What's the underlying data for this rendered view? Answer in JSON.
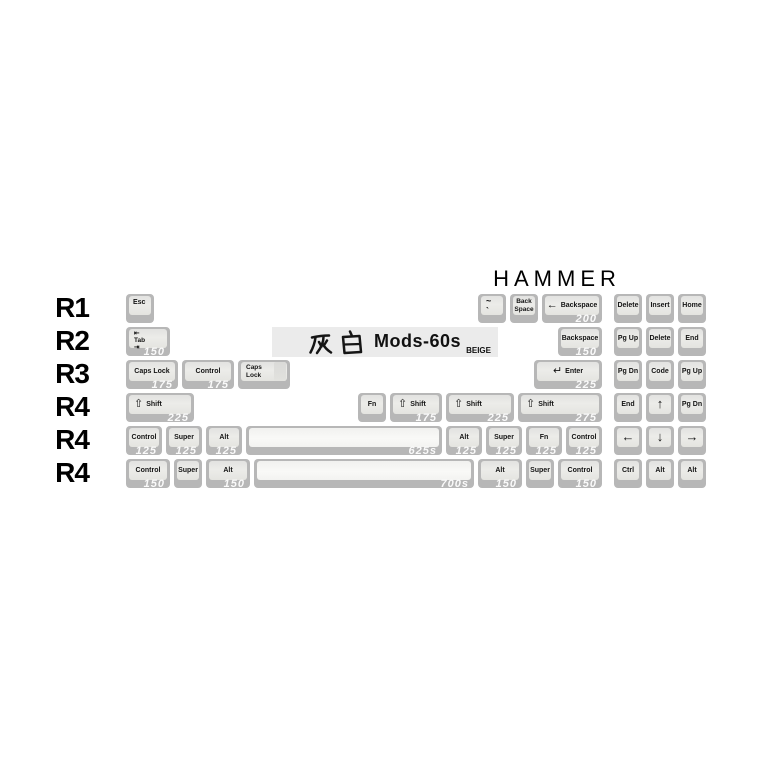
{
  "title": "HAMMER",
  "banner": {
    "cjk": "灰白",
    "series": "Mods-60s",
    "colorway": "BEIGE"
  },
  "colors": {
    "page_bg": "#ffffff",
    "key_base": "#b7b7b7",
    "keycap_top": "#e9e9e7",
    "spacebar_top": "#f6f6f4",
    "legend": "#141414",
    "size_label": "#fafafa",
    "banner_bg": "#ebebeb",
    "title_text": "#000000"
  },
  "rows": [
    {
      "label": "R1",
      "keys": [
        {
          "legend": "Esc",
          "u": 0,
          "w": 1,
          "style": "tl"
        },
        {
          "lines": [
            "~",
            "`"
          ],
          "u": 11,
          "w": 1,
          "name": "tilde",
          "style": "tl2"
        },
        {
          "lines": [
            "Back",
            "Space"
          ],
          "u": 12,
          "w": 1,
          "name": "back-space",
          "style": "two"
        },
        {
          "legend": "Backspace",
          "icon": "←",
          "u": 13,
          "w": 2,
          "size": "200",
          "style": "iconrowc"
        },
        {
          "legend": "Delete",
          "u": 15.25,
          "w": 1
        },
        {
          "legend": "Insert",
          "u": 16.25,
          "w": 1
        },
        {
          "legend": "Home",
          "u": 17.25,
          "w": 1
        }
      ]
    },
    {
      "label": "R2",
      "keys": [
        {
          "lines": [
            "⇤",
            "Tab",
            "⇥"
          ],
          "u": 0,
          "w": 1.5,
          "name": "tab",
          "style": "tabkey",
          "size": "150"
        },
        {
          "legend": "Backspace",
          "u": 13.5,
          "w": 1.5,
          "size": "150"
        },
        {
          "legend": "Pg Up",
          "u": 15.25,
          "w": 1
        },
        {
          "legend": "Delete",
          "u": 16.25,
          "w": 1
        },
        {
          "legend": "End",
          "u": 17.25,
          "w": 1
        }
      ]
    },
    {
      "label": "R3",
      "keys": [
        {
          "legend": "Caps Lock",
          "u": 0,
          "w": 1.75,
          "size": "175"
        },
        {
          "legend": "Control",
          "u": 1.75,
          "w": 1.75,
          "size": "175"
        },
        {
          "lines": [
            "Caps",
            "Lock"
          ],
          "u": 3.5,
          "w": 1.75,
          "name": "caps-lock-stepped",
          "style": "twol",
          "stepped": true
        },
        {
          "legend": "Enter",
          "icon": "↵",
          "u": 12.75,
          "w": 2.25,
          "size": "225",
          "style": "iconrowc"
        },
        {
          "legend": "Pg Dn",
          "u": 15.25,
          "w": 1
        },
        {
          "legend": "Code",
          "u": 16.25,
          "w": 1
        },
        {
          "legend": "Pg Up",
          "u": 17.25,
          "w": 1
        }
      ]
    },
    {
      "label": "R4",
      "keys": [
        {
          "legend": "Shift",
          "icon": "⇧",
          "u": 0,
          "w": 2.25,
          "size": "225",
          "style": "iconrow"
        },
        {
          "legend": "Fn",
          "u": 7.25,
          "w": 1
        },
        {
          "legend": "Shift",
          "icon": "⇧",
          "u": 8.25,
          "w": 1.75,
          "size": "175",
          "style": "iconrow"
        },
        {
          "legend": "Shift",
          "icon": "⇧",
          "u": 10,
          "w": 2.25,
          "size": "225",
          "style": "iconrow"
        },
        {
          "legend": "Shift",
          "icon": "⇧",
          "u": 12.25,
          "w": 2.75,
          "size": "275",
          "style": "iconrow"
        },
        {
          "legend": "End",
          "u": 15.25,
          "w": 1
        },
        {
          "legend": "↑",
          "u": 16.25,
          "w": 1,
          "big": true,
          "name": "up-arrow"
        },
        {
          "legend": "Pg Dn",
          "u": 17.25,
          "w": 1
        }
      ]
    },
    {
      "label": "R4",
      "keys": [
        {
          "legend": "Control",
          "u": 0,
          "w": 1.25,
          "size": "125"
        },
        {
          "legend": "Super",
          "u": 1.25,
          "w": 1.25,
          "size": "125"
        },
        {
          "legend": "Alt",
          "u": 2.5,
          "w": 1.25,
          "size": "125"
        },
        {
          "legend": "",
          "u": 3.75,
          "w": 6.25,
          "size": "625s",
          "space": true,
          "name": "spacebar-625"
        },
        {
          "legend": "Alt",
          "u": 10,
          "w": 1.25,
          "size": "125"
        },
        {
          "legend": "Super",
          "u": 11.25,
          "w": 1.25,
          "size": "125"
        },
        {
          "legend": "Fn",
          "u": 12.5,
          "w": 1.25,
          "size": "125"
        },
        {
          "legend": "Control",
          "u": 13.75,
          "w": 1.25,
          "size": "125"
        },
        {
          "legend": "←",
          "u": 15.25,
          "w": 1,
          "big": true,
          "name": "left-arrow"
        },
        {
          "legend": "↓",
          "u": 16.25,
          "w": 1,
          "big": true,
          "name": "down-arrow"
        },
        {
          "legend": "→",
          "u": 17.25,
          "w": 1,
          "big": true,
          "name": "right-arrow"
        }
      ]
    },
    {
      "label": "R4",
      "keys": [
        {
          "legend": "Control",
          "u": 0,
          "w": 1.5,
          "size": "150"
        },
        {
          "legend": "Super",
          "u": 1.5,
          "w": 1
        },
        {
          "legend": "Alt",
          "u": 2.5,
          "w": 1.5,
          "size": "150"
        },
        {
          "legend": "",
          "u": 4,
          "w": 7,
          "size": "700s",
          "space": true,
          "name": "spacebar-700"
        },
        {
          "legend": "Alt",
          "u": 11,
          "w": 1.5,
          "size": "150"
        },
        {
          "legend": "Super",
          "u": 12.5,
          "w": 1
        },
        {
          "legend": "Control",
          "u": 13.5,
          "w": 1.5,
          "size": "150"
        },
        {
          "legend": "Ctrl",
          "u": 15.25,
          "w": 1
        },
        {
          "legend": "Alt",
          "u": 16.25,
          "w": 1
        },
        {
          "legend": "Alt",
          "u": 17.25,
          "w": 1
        }
      ]
    }
  ]
}
